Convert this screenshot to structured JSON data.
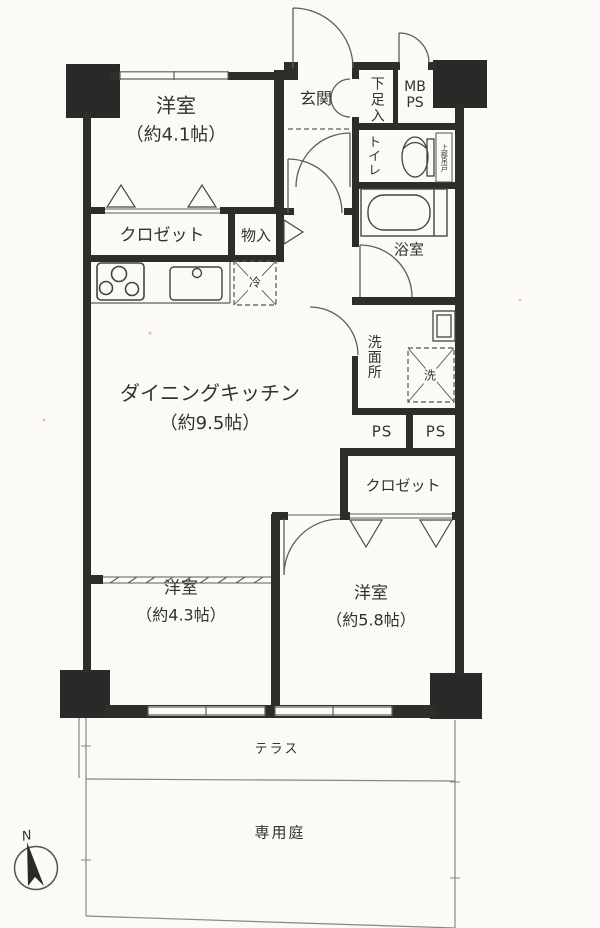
{
  "plan_title": "apartment-floor-plan",
  "rooms": {
    "western_room_1": {
      "label": "洋室",
      "size": "（約4.1帖）"
    },
    "entrance": {
      "label": "玄関"
    },
    "shoe_box": {
      "label": "下足入"
    },
    "meter_box": {
      "line1": "MB",
      "line2": "PS"
    },
    "toilet": {
      "label": "トイレ",
      "note": "上部吊戸"
    },
    "bathroom": {
      "label": "浴室"
    },
    "closet_1": {
      "label": "クロゼット"
    },
    "storage": {
      "label": "物入"
    },
    "refrigerator": {
      "label": "冷"
    },
    "dining_kitchen": {
      "label": "ダイニングキッチン",
      "size": "（約9.5帖）"
    },
    "washroom": {
      "label": "洗面所"
    },
    "washer": {
      "label": "洗"
    },
    "pipe_space_1": {
      "label": "PS"
    },
    "pipe_space_2": {
      "label": "PS"
    },
    "closet_2": {
      "label": "クロゼット"
    },
    "western_room_2": {
      "label": "洋室",
      "size": "（約4.3帖）"
    },
    "western_room_3": {
      "label": "洋室",
      "size": "（約5.8帖）"
    },
    "terrace": {
      "label": "テラス"
    },
    "private_garden": {
      "label": "専用庭"
    }
  },
  "compass": {
    "label": "N"
  },
  "colors": {
    "wall": "#2e2d2a",
    "thin_line": "#5f5d5a",
    "garden_line": "#8a8784",
    "text": "#34322f",
    "paper": "#fbfaf6"
  }
}
